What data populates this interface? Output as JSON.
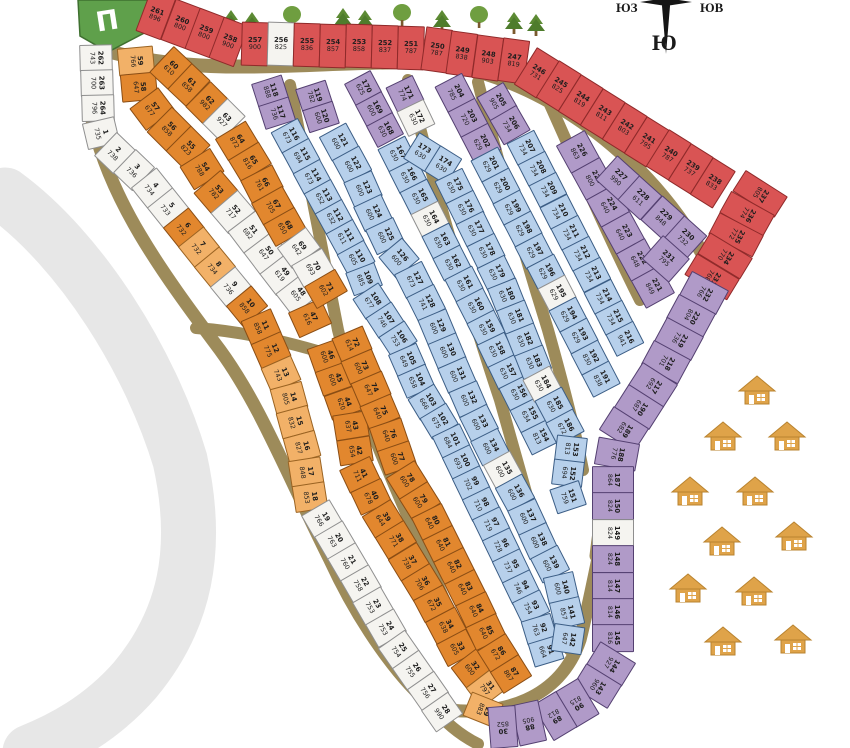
{
  "compass": {
    "south_label": "Ю",
    "southwest_label": "ЮЗ",
    "southeast_label": "ЮВ"
  },
  "entrance": {
    "label": "П"
  },
  "palette": {
    "red": "#d95454",
    "orange": "#e2872e",
    "orange_light": "#f2b168",
    "blue": "#b7d0eb",
    "purple": "#b09ac8",
    "white": "#f5f4f0",
    "road": "#9d8b5a",
    "river": "#e7e7e7",
    "green": "#5fa04b",
    "tree_dark": "#4e7c2c",
    "tree_light": "#6f9e40",
    "house": "#dfa349"
  },
  "houses": {
    "count": 11
  },
  "trees": {
    "count": 10
  },
  "blocks": [
    {
      "id": "red-top",
      "color": "red",
      "plots": [
        {
          "n": 261,
          "a": 896
        },
        {
          "n": 260,
          "a": 800
        },
        {
          "n": 259,
          "a": 800
        },
        {
          "n": 258,
          "a": 900
        },
        {
          "n": 257,
          "a": 900
        },
        {
          "n": 256,
          "a": 825,
          "c": "white"
        },
        {
          "n": 255,
          "a": 836
        },
        {
          "n": 254,
          "a": 857
        },
        {
          "n": 253,
          "a": 858
        },
        {
          "n": 252,
          "a": 837
        },
        {
          "n": 251,
          "a": 787
        },
        {
          "n": 250,
          "a": 787
        },
        {
          "n": 249,
          "a": 838
        },
        {
          "n": 248,
          "a": 903
        },
        {
          "n": 247,
          "a": 819
        },
        {
          "n": 246,
          "a": 731
        },
        {
          "n": 245,
          "a": 825
        },
        {
          "n": 244,
          "a": 819
        },
        {
          "n": 243,
          "a": 811
        },
        {
          "n": 242,
          "a": 803
        },
        {
          "n": 241,
          "a": 795
        },
        {
          "n": 240,
          "a": 787
        },
        {
          "n": 239,
          "a": 737
        },
        {
          "n": 238,
          "a": 833
        }
      ]
    },
    {
      "id": "red-right",
      "color": "red",
      "plots": [
        {
          "n": 237,
          "a": 805
        },
        {
          "n": 236,
          "a": 774
        },
        {
          "n": 235,
          "a": 772
        },
        {
          "n": 234,
          "a": 770
        },
        {
          "n": 233,
          "a": 768
        }
      ]
    },
    {
      "id": "left-strip",
      "color": "white",
      "plots": [
        {
          "n": 262,
          "a": 743
        },
        {
          "n": 263,
          "a": 700
        },
        {
          "n": 264,
          "a": 796
        },
        {
          "n": 1,
          "a": 735
        },
        {
          "n": 2,
          "a": 738
        },
        {
          "n": 3,
          "a": 736
        },
        {
          "n": 4,
          "a": 734
        },
        {
          "n": 5,
          "a": 733
        },
        {
          "n": 6,
          "a": 732,
          "c": "orange"
        },
        {
          "n": 7,
          "a": 732,
          "c": "orange_light"
        },
        {
          "n": 8,
          "a": 734,
          "c": "orange_light"
        },
        {
          "n": 9,
          "a": 736
        },
        {
          "n": 10,
          "a": 858,
          "c": "orange"
        },
        {
          "n": 11,
          "a": 858,
          "c": "orange"
        },
        {
          "n": 12,
          "a": 775,
          "c": "orange"
        },
        {
          "n": 13,
          "a": 743,
          "c": "orange_light"
        },
        {
          "n": 14,
          "a": 805,
          "c": "orange_light"
        },
        {
          "n": 15,
          "a": 832,
          "c": "orange_light"
        },
        {
          "n": 16,
          "a": 827,
          "c": "orange_light"
        },
        {
          "n": 17,
          "a": 848,
          "c": "orange_light"
        },
        {
          "n": 18,
          "a": 853,
          "c": "orange_light"
        },
        {
          "n": 19,
          "a": 766
        },
        {
          "n": 20,
          "a": 763
        },
        {
          "n": 21,
          "a": 760
        },
        {
          "n": 22,
          "a": 758
        },
        {
          "n": 23,
          "a": 753
        },
        {
          "n": 24,
          "a": 753
        },
        {
          "n": 25,
          "a": 754
        },
        {
          "n": 26,
          "a": 755
        },
        {
          "n": 27,
          "a": 756
        },
        {
          "n": 28,
          "a": 990
        }
      ]
    },
    {
      "id": "orange1-a",
      "color": "orange",
      "plots": [
        {
          "n": 59,
          "a": 766,
          "c": "orange_light"
        },
        {
          "n": 58,
          "a": 647
        },
        {
          "n": 57,
          "a": 677
        },
        {
          "n": 56,
          "a": 858
        },
        {
          "n": 55,
          "a": 823
        },
        {
          "n": 54,
          "a": 788
        },
        {
          "n": 53,
          "a": 782
        },
        {
          "n": 52,
          "a": 717,
          "c": "white"
        },
        {
          "n": 51,
          "a": 682,
          "c": "white"
        },
        {
          "n": 50,
          "a": 647,
          "c": "white"
        },
        {
          "n": 49,
          "a": 619,
          "c": "white"
        },
        {
          "n": 48,
          "a": 605,
          "c": "white"
        },
        {
          "n": 47,
          "a": 616
        }
      ]
    },
    {
      "id": "orange1-b",
      "color": "orange",
      "plots": [
        {
          "n": 60,
          "a": 610
        },
        {
          "n": 61,
          "a": 858
        },
        {
          "n": 62,
          "a": 982
        },
        {
          "n": 63,
          "a": 927,
          "c": "white"
        },
        {
          "n": 64,
          "a": 872
        },
        {
          "n": 65,
          "a": 816
        },
        {
          "n": 66,
          "a": 761
        },
        {
          "n": 67,
          "a": 705
        },
        {
          "n": 68,
          "a": 650
        },
        {
          "n": 69,
          "a": 642,
          "c": "white"
        },
        {
          "n": 70,
          "a": 693,
          "c": "white"
        },
        {
          "n": 71,
          "a": 602
        }
      ]
    },
    {
      "id": "orange2-l",
      "color": "orange",
      "plots": [
        {
          "n": 46,
          "a": 600
        },
        {
          "n": 45,
          "a": 600
        },
        {
          "n": 44,
          "a": 620
        },
        {
          "n": 43,
          "a": 637
        },
        {
          "n": 42,
          "a": 654
        },
        {
          "n": 41,
          "a": 711
        },
        {
          "n": 40,
          "a": 678
        },
        {
          "n": 39,
          "a": 644
        },
        {
          "n": 38,
          "a": 771
        },
        {
          "n": 37,
          "a": 738
        },
        {
          "n": 36,
          "a": 706
        },
        {
          "n": 35,
          "a": 672
        },
        {
          "n": 34,
          "a": 638
        },
        {
          "n": 33,
          "a": 605
        },
        {
          "n": 32,
          "a": 600
        },
        {
          "n": 31,
          "a": 797,
          "c": "orange_light"
        },
        {
          "n": 29,
          "a": 883,
          "c": "orange_light"
        }
      ]
    },
    {
      "id": "orange2-r",
      "color": "orange",
      "plots": [
        {
          "n": 72,
          "a": 614
        },
        {
          "n": 73,
          "a": 600
        },
        {
          "n": 74,
          "a": 647
        },
        {
          "n": 75,
          "a": 640
        },
        {
          "n": 76,
          "a": 640
        },
        {
          "n": 77,
          "a": 600
        },
        {
          "n": 78,
          "a": 600
        },
        {
          "n": 79,
          "a": 600
        },
        {
          "n": 80,
          "a": 640
        },
        {
          "n": 81,
          "a": 640
        },
        {
          "n": 82,
          "a": 640
        },
        {
          "n": 83,
          "a": 640
        },
        {
          "n": 84,
          "a": 640
        },
        {
          "n": 85,
          "a": 640
        },
        {
          "n": 86,
          "a": 672
        },
        {
          "n": 87,
          "a": 867
        }
      ]
    },
    {
      "id": "bluea-p1",
      "color": "purple",
      "plots": [
        {
          "n": 118,
          "a": 888
        },
        {
          "n": 117,
          "a": 736
        }
      ]
    },
    {
      "id": "bluea-p2",
      "color": "purple",
      "plots": [
        {
          "n": 119,
          "a": 782
        },
        {
          "n": 120,
          "a": 600
        }
      ]
    },
    {
      "id": "bluea-l",
      "color": "blue",
      "plots": [
        {
          "n": 116,
          "a": 673
        },
        {
          "n": 115,
          "a": 694
        },
        {
          "n": 114,
          "a": 673
        },
        {
          "n": 113,
          "a": 652
        },
        {
          "n": 112,
          "a": 632
        },
        {
          "n": 111,
          "a": 611
        },
        {
          "n": 110,
          "a": 605
        },
        {
          "n": 109,
          "a": 685
        },
        {
          "n": 108,
          "a": 677
        },
        {
          "n": 107,
          "a": 746
        },
        {
          "n": 106,
          "a": 753
        },
        {
          "n": 105,
          "a": 649
        },
        {
          "n": 104,
          "a": 658
        },
        {
          "n": 103,
          "a": 666
        },
        {
          "n": 102,
          "a": 675
        },
        {
          "n": 101,
          "a": 684
        },
        {
          "n": 100,
          "a": 693
        },
        {
          "n": 99,
          "a": 702
        },
        {
          "n": 98,
          "a": 710
        },
        {
          "n": 97,
          "a": 719
        },
        {
          "n": 96,
          "a": 728
        },
        {
          "n": 95,
          "a": 737
        },
        {
          "n": 94,
          "a": 746
        },
        {
          "n": 93,
          "a": 754
        },
        {
          "n": 92,
          "a": 763
        },
        {
          "n": 91,
          "a": 664
        }
      ]
    },
    {
      "id": "bluea-r",
      "color": "blue",
      "plots": [
        {
          "n": 121,
          "a": 600
        },
        {
          "n": 122,
          "a": 600
        },
        {
          "n": 123,
          "a": 600
        },
        {
          "n": 124,
          "a": 600
        },
        {
          "n": 125,
          "a": 600
        },
        {
          "n": 126,
          "a": 600
        },
        {
          "n": 127,
          "a": 673
        },
        {
          "n": 128,
          "a": 741
        },
        {
          "n": 129,
          "a": 600
        },
        {
          "n": 130,
          "a": 600
        },
        {
          "n": 131,
          "a": 600
        },
        {
          "n": 132,
          "a": 600
        },
        {
          "n": 133,
          "a": 600
        },
        {
          "n": 134,
          "a": 600
        },
        {
          "n": 135,
          "a": 600,
          "c": "white"
        },
        {
          "n": 136,
          "a": 600
        },
        {
          "n": 137,
          "a": 600
        },
        {
          "n": 138,
          "a": 600
        },
        {
          "n": 139,
          "a": 600
        },
        {
          "n": 140,
          "a": 600
        },
        {
          "n": 141,
          "a": 857
        },
        {
          "n": 142,
          "a": 647
        }
      ]
    },
    {
      "id": "blueb-p1",
      "color": "purple",
      "plots": [
        {
          "n": 170,
          "a": 625
        },
        {
          "n": 169,
          "a": 600
        },
        {
          "n": 168,
          "a": 630
        }
      ]
    },
    {
      "id": "blueb-p2",
      "color": "purple",
      "plots": [
        {
          "n": 171,
          "a": 774
        },
        {
          "n": 172,
          "a": 630,
          "c": "white"
        }
      ]
    },
    {
      "id": "blueb-l",
      "color": "blue",
      "plots": [
        {
          "n": 167,
          "a": 630
        },
        {
          "n": 166,
          "a": 630
        },
        {
          "n": 165,
          "a": 630
        },
        {
          "n": 164,
          "a": 630,
          "c": "white"
        },
        {
          "n": 163,
          "a": 630
        },
        {
          "n": 162,
          "a": 630
        },
        {
          "n": 161,
          "a": 630
        },
        {
          "n": 160,
          "a": 630
        },
        {
          "n": 159,
          "a": 630
        },
        {
          "n": 158,
          "a": 630
        },
        {
          "n": 157,
          "a": 630
        },
        {
          "n": 156,
          "a": 630
        },
        {
          "n": 155,
          "a": 634
        },
        {
          "n": 154,
          "a": 813
        }
      ]
    },
    {
      "id": "blueb-r",
      "color": "blue",
      "plots": [
        {
          "n": 173,
          "a": 630
        },
        {
          "n": 174,
          "a": 630
        },
        {
          "n": 175,
          "a": 630
        },
        {
          "n": 176,
          "a": 630
        },
        {
          "n": 177,
          "a": 630
        },
        {
          "n": 178,
          "a": 630
        },
        {
          "n": 179,
          "a": 630
        },
        {
          "n": 180,
          "a": 630
        },
        {
          "n": 181,
          "a": 630
        },
        {
          "n": 182,
          "a": 630
        },
        {
          "n": 183,
          "a": 630
        },
        {
          "n": 184,
          "a": 630,
          "c": "white"
        },
        {
          "n": 185,
          "a": 630
        },
        {
          "n": 186,
          "a": 672
        },
        {
          "n": 153,
          "a": 813
        },
        {
          "n": 152,
          "a": 694
        },
        {
          "n": 151,
          "a": 759
        }
      ]
    },
    {
      "id": "bluec-p1",
      "color": "purple",
      "plots": [
        {
          "n": 204,
          "a": 785
        },
        {
          "n": 203,
          "a": 720
        },
        {
          "n": 202,
          "a": 629
        }
      ]
    },
    {
      "id": "bluec-p2",
      "color": "purple",
      "plots": [
        {
          "n": 205,
          "a": 905
        },
        {
          "n": 206,
          "a": 734
        }
      ]
    },
    {
      "id": "bluec-l",
      "color": "blue",
      "plots": [
        {
          "n": 201,
          "a": 629
        },
        {
          "n": 200,
          "a": 629
        },
        {
          "n": 199,
          "a": 629
        },
        {
          "n": 198,
          "a": 629
        },
        {
          "n": 197,
          "a": 629
        },
        {
          "n": 196,
          "a": 629
        },
        {
          "n": 195,
          "a": 629,
          "c": "white"
        },
        {
          "n": 194,
          "a": 629
        },
        {
          "n": 193,
          "a": 629
        },
        {
          "n": 192,
          "a": 830
        },
        {
          "n": 191,
          "a": 838
        }
      ]
    },
    {
      "id": "bluec-r",
      "color": "blue",
      "plots": [
        {
          "n": 207,
          "a": 734
        },
        {
          "n": 208,
          "a": 734
        },
        {
          "n": 209,
          "a": 734
        },
        {
          "n": 210,
          "a": 734
        },
        {
          "n": 211,
          "a": 734
        },
        {
          "n": 212,
          "a": 734
        },
        {
          "n": 213,
          "a": 734
        },
        {
          "n": 214,
          "a": 734
        },
        {
          "n": 215,
          "a": 734
        },
        {
          "n": 216,
          "a": 941
        }
      ]
    },
    {
      "id": "purplet-l",
      "color": "purple",
      "plots": [
        {
          "n": 226,
          "a": 863
        },
        {
          "n": 225,
          "a": 800
        },
        {
          "n": 224,
          "a": 640
        },
        {
          "n": 223,
          "a": 640
        },
        {
          "n": 222,
          "a": 648
        },
        {
          "n": 221,
          "a": 849
        }
      ]
    },
    {
      "id": "purplet-r",
      "color": "purple",
      "plots": [
        {
          "n": 227,
          "a": 990
        },
        {
          "n": 228,
          "a": 611
        },
        {
          "n": 229,
          "a": 848
        },
        {
          "n": 230,
          "a": 732
        }
      ]
    },
    {
      "id": "plot-231",
      "color": "purple",
      "plots": [
        {
          "n": 231,
          "a": 795
        }
      ]
    },
    {
      "id": "purple-arc",
      "color": "purple",
      "plots": [
        {
          "n": 232,
          "a": 766
        },
        {
          "n": 220,
          "a": 804
        },
        {
          "n": 219,
          "a": 736
        },
        {
          "n": 218,
          "a": 701
        },
        {
          "n": 217,
          "a": 692
        },
        {
          "n": 190,
          "a": 687
        },
        {
          "n": 189,
          "a": 682
        },
        {
          "n": 188,
          "a": 776
        },
        {
          "n": 187,
          "a": 864
        },
        {
          "n": 150,
          "a": 824
        },
        {
          "n": 149,
          "a": 824,
          "c": "white"
        },
        {
          "n": 148,
          "a": 824
        },
        {
          "n": 147,
          "a": 814
        },
        {
          "n": 146,
          "a": 814
        },
        {
          "n": 145,
          "a": 816
        },
        {
          "n": 144,
          "a": 927
        },
        {
          "n": 143,
          "a": 960
        },
        {
          "n": 90,
          "a": 815
        },
        {
          "n": 89,
          "a": 812
        },
        {
          "n": 88,
          "a": 905
        },
        {
          "n": 30,
          "a": 852
        }
      ]
    }
  ]
}
